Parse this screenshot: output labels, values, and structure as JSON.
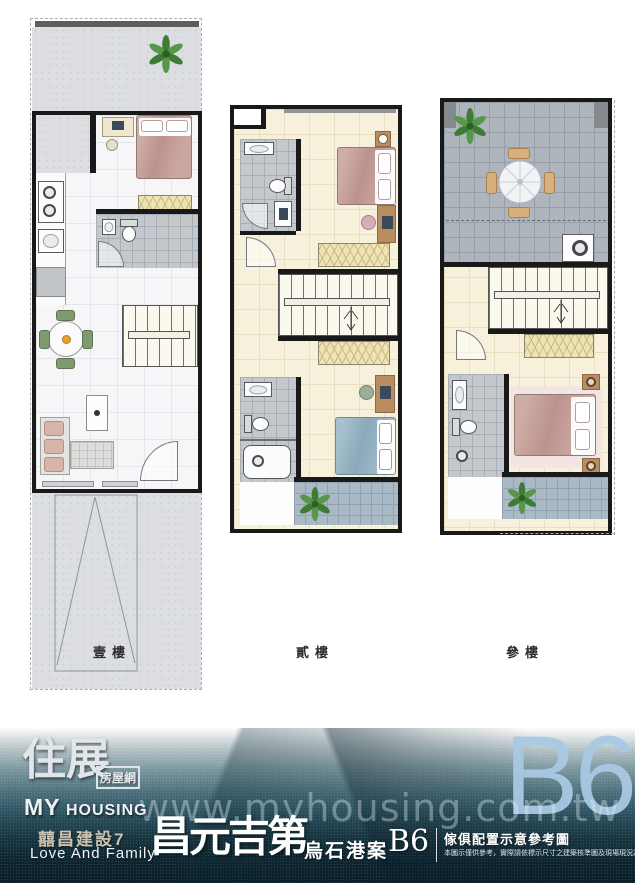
{
  "floors": [
    {
      "label": "壹樓"
    },
    {
      "label": "貳樓"
    },
    {
      "label": "參樓"
    }
  ],
  "footer": {
    "logo": {
      "brand_cn": "住展",
      "brand_suffix": "房屋網",
      "brand_en_1": "MY",
      "brand_en_2": "HOUSING"
    },
    "watermark": "www.myhousing.com.tw",
    "unit_badge": "B6",
    "builder": "囍昌建設7",
    "builder_en": "Love And Family",
    "project_name": "昌元吉第",
    "case_name": "烏石港案",
    "unit": "B6",
    "note_title": "傢俱配置示意參考圖",
    "note_body": "本圖示僅供參考，實際請依標示尺寸之建築核準圖及現場現況為準。"
  },
  "colors": {
    "wall": "#191919",
    "footer_teal": "#1c3b46",
    "unit_blue": "#a9c9e3",
    "bed_mauve": "#c59b94",
    "bed_blue": "#92b2c3",
    "closet_cream": "#efe3b4",
    "plant_green": "#3e7c33",
    "terrace_gray": "#aeb5bd"
  }
}
